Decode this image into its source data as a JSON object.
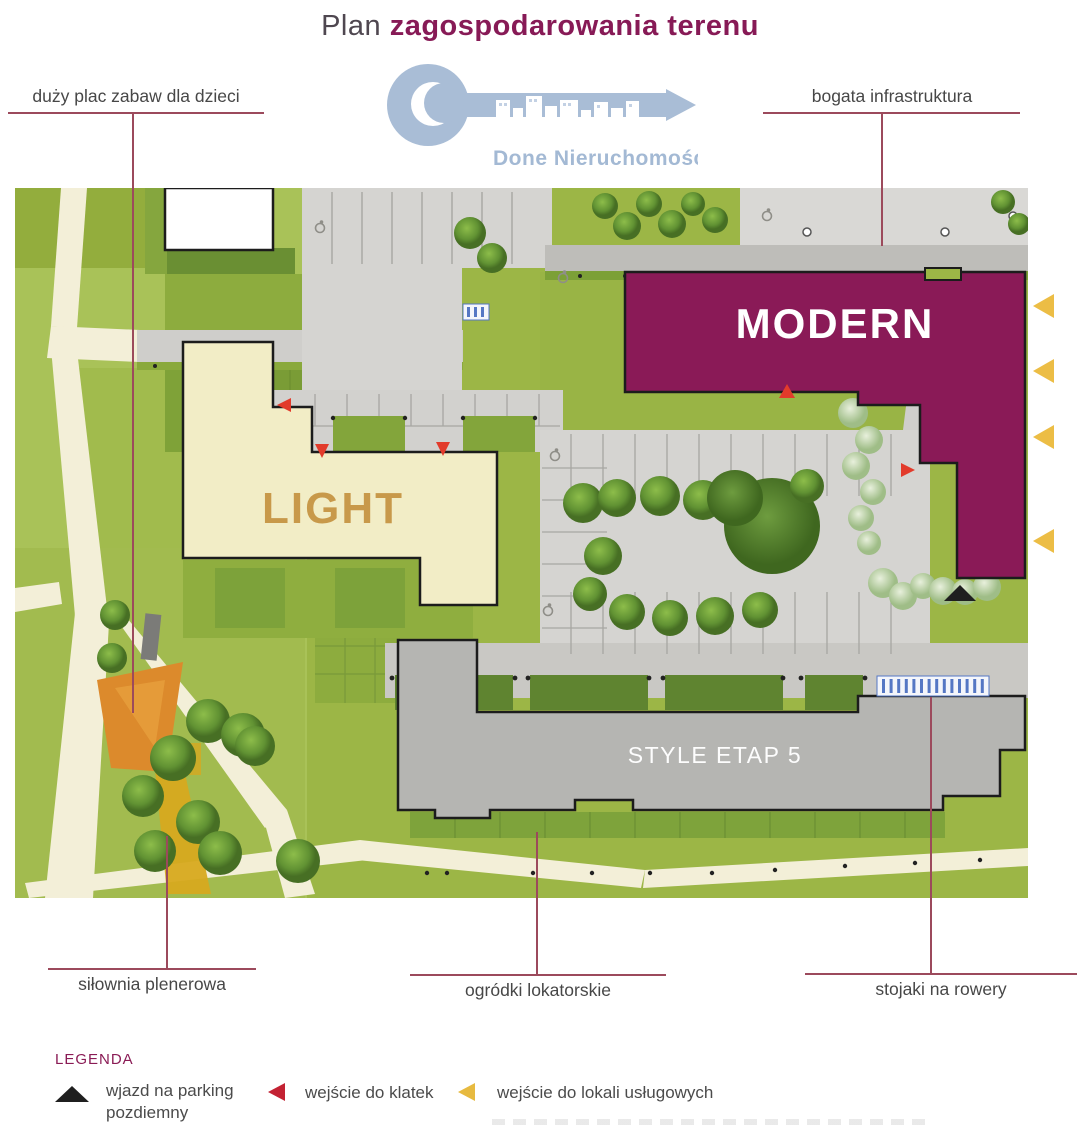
{
  "title": {
    "prefix": "Plan",
    "emphasis": "zagospodarowania terenu"
  },
  "logo": {
    "text": "Done Nieruchomości",
    "color": "#a9bdd6"
  },
  "annotations": {
    "top_left": "duży plac zabaw dla dzieci",
    "top_right": "bogata infrastruktura",
    "bottom_left": "siłownia plenerowa",
    "bottom_center": "ogródki lokatorskie",
    "bottom_right": "stojaki na rowery"
  },
  "map": {
    "buildings": [
      {
        "id": "light",
        "label": "LIGHT",
        "fill": "#f2edc6",
        "label_color": "#c8994a"
      },
      {
        "id": "modern",
        "label": "MODERN",
        "fill": "#8a1a57",
        "label_color": "#ffffff"
      },
      {
        "id": "style-etap-5",
        "label": "STYLE ETAP 5",
        "fill": "#b5b5b2",
        "label_color": "#ffffff"
      }
    ],
    "marker_colors": {
      "underground_parking_entrance": "#1f1f1f",
      "staircase_entrance": "#e23b2b",
      "service_unit_entrance": "#ecbd45",
      "bike_rack": "#5577c4"
    }
  },
  "legend": {
    "title": "LEGENDA",
    "items": [
      {
        "symbol": "black-up-triangle",
        "color": "#1f1f1f",
        "label": "wjazd na parking pozdiemny"
      },
      {
        "symbol": "red-left-triangle",
        "color": "#c32233",
        "label": "wejście do klatek"
      },
      {
        "symbol": "gold-left-triangle",
        "color": "#e7ba40",
        "label": "wejście do lokali usługowych"
      }
    ]
  },
  "colors": {
    "title_accent": "#871a56",
    "callout_line": "#9c4a5c",
    "grass": "#9cb646",
    "road": "#d4d3d0",
    "path": "#f3efd8"
  }
}
